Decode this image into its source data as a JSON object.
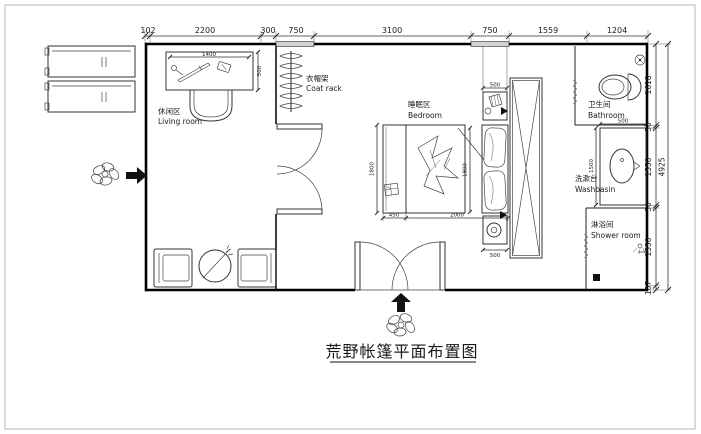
{
  "title": "荒野帐篷平面布置图",
  "labels": {
    "living": {
      "zh": "休闲区",
      "en": "Living room"
    },
    "coat_rack": {
      "zh": "衣帽架",
      "en": "Coat rack"
    },
    "bedroom": {
      "zh": "睡眠区",
      "en": "Bedroom"
    },
    "bathroom": {
      "zh": "卫生间",
      "en": "Bathroom"
    },
    "washbasin": {
      "zh": "洗漱台",
      "en": "Washbasin"
    },
    "shower": {
      "zh": "淋浴间",
      "en": "Shower room"
    }
  },
  "dims": {
    "top": [
      "102",
      "2200",
      "300",
      "750",
      "3100",
      "750",
      "1559",
      "1204"
    ],
    "right": [
      "1618",
      "50",
      "1550",
      "50",
      "1550",
      "107"
    ],
    "right_total": "4925",
    "interior": {
      "desk_width": "1400",
      "desk_depth": "500",
      "bed_bench": "450",
      "bed_length": "2000",
      "bed_width": "1800",
      "bed_width2": "1800",
      "nightstand_top": "500",
      "nightstand_bottom": "500",
      "basin_width": "500",
      "basin_depth": "1500"
    }
  },
  "colors": {
    "ink": "#1a1a1a",
    "wall": "#000000",
    "paper": "#ffffff"
  }
}
